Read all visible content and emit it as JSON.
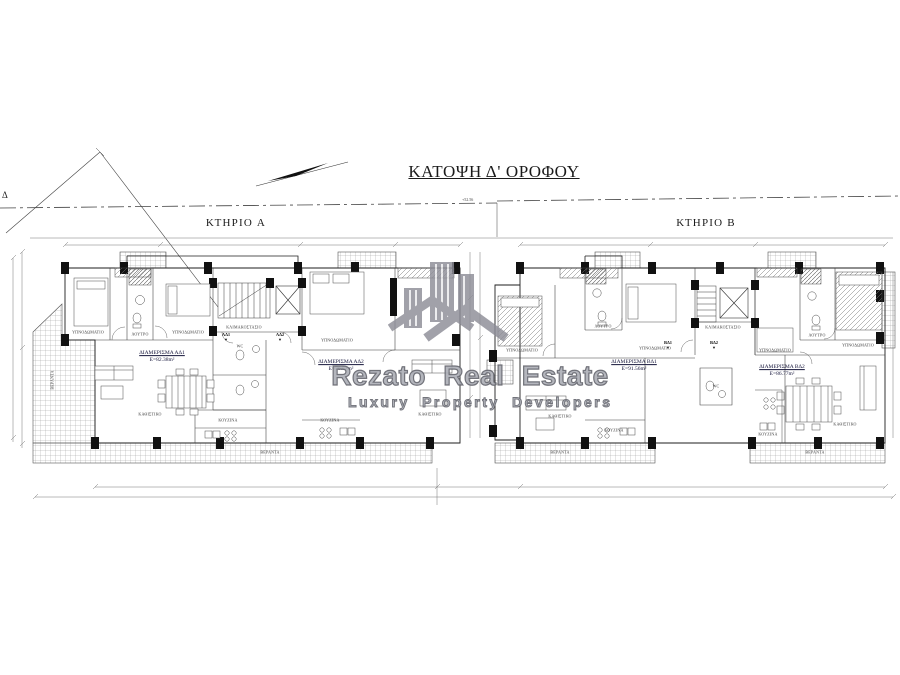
{
  "title": "ΚΑΤΟΨΗ Δ' ΟΡΟΦΟΥ",
  "site": {
    "elevation_mark": "+52.56",
    "plot_corner_label": "Δ"
  },
  "buildings": [
    {
      "label": "ΚΤΗΡΙΟ A",
      "apartments": [
        {
          "name": "ΔΙΑΜΕΡΙΣΜΑ ΑΔ1",
          "area": "E=82.38m²",
          "entry_tag": "ΑΔ1"
        },
        {
          "name": "ΔΙΑΜΕΡΙΣΜΑ ΑΔ2",
          "area": "E=76.57m²",
          "entry_tag": "ΑΔ2"
        }
      ]
    },
    {
      "label": "ΚΤΗΡΙΟ B",
      "apartments": [
        {
          "name": "ΔΙΑΜΕΡΙΣΜΑ ΒΔ1",
          "area": "E=91.56m²",
          "entry_tag": "ΒΔ1"
        },
        {
          "name": "ΔΙΑΜΕΡΙΣΜΑ ΒΔ2",
          "area": "E=86.77m²",
          "entry_tag": "ΒΔ2"
        }
      ]
    }
  ],
  "rooms": {
    "bedroom": "ΥΠΝΟΔΩΜΑΤΙΟ",
    "living": "ΚΑΘΙΣΤΙΚΟ",
    "kitchen": "ΚΟΥΖΙΝΑ",
    "bath": "ΛΟΥΤΡΟ",
    "wc": "WC",
    "veranda": "ΒΕΡΑΝΤΑ",
    "stairwell": "ΚΛΙΜΑΚΟΣΤΑΣΙΟ"
  },
  "watermark": {
    "brand": "Rezato Real Estate",
    "tagline": "Luxury Property Developers",
    "color": "#8d8d97"
  }
}
